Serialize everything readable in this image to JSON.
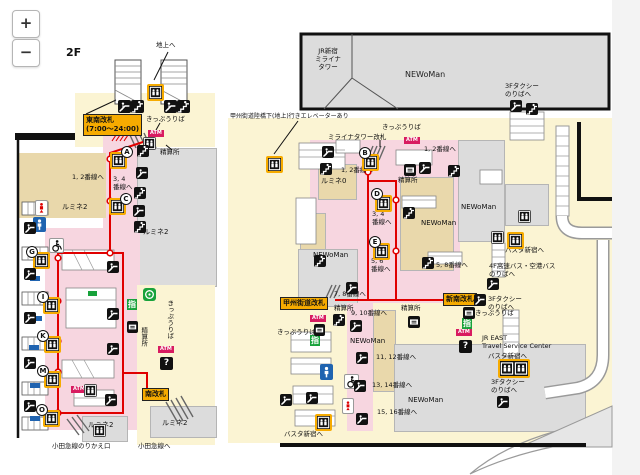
{
  "controls": {
    "zoom_in": "+",
    "zoom_out": "−"
  },
  "floor_label": "2F",
  "colors": {
    "concourse_pink": "#f7d6e0",
    "free_area_yellow": "#fbf4d3",
    "shop_tan": "#e9d8ab",
    "building_gray": "#dcdcdc",
    "gate_orange": "#f6ab00",
    "route_red": "#e00000",
    "atm_magenta": "#d81b60",
    "reserved_seat_green": "#18a23b",
    "restroom_blue": "#1f63b0"
  },
  "left": {
    "to_ground": "地上へ",
    "gate_tonan_l1": "東南改札",
    "gate_tonan_l2": "(7:00～24:00)",
    "ticket_top": "きっぷうりば",
    "fare_top": "精算所",
    "pf12": "1, 2番線へ",
    "pf34_l1": "3, 4",
    "pf34_l2": "番線へ",
    "lumine_left": "ルミネ2",
    "lumine_right": "ルミネ2",
    "lumine_bottom": "ルミネ2",
    "lumine_bottom_right": "ルミネ2",
    "ticket_vert": "きっぷうりば",
    "fare_vert": "精算所",
    "atm_top": "ATM",
    "atm_mid": "ATM",
    "atm_bottom": "ATM",
    "shitei": "指",
    "info_mark": "?",
    "gate_minami": "南改札",
    "odakyu_transfer": "小田急線のりかえ口",
    "odakyu_to": "小田急線へ",
    "letters": {
      "a": "A",
      "c": "C",
      "g": "G",
      "i": "I",
      "k": "K",
      "m": "M",
      "o": "O"
    }
  },
  "right": {
    "tower_l1": "JR新宿",
    "tower_l2": "ミライナ",
    "tower_l3": "タワー",
    "newoman_top": "NEWoMan",
    "elevator_note": "甲州街道陸橋下(地上)行きエレベーターあり",
    "ticket_top": "きっぷうりば",
    "gate_miraina": "ミライナタワー改札",
    "atm_top": "ATM",
    "pf12_right": "1, 2番線へ",
    "pf12_small": "1, 2番線へ",
    "lumine0": "ルミネ0",
    "pf34_l1": "3, 4",
    "pf34_l2": "番線へ",
    "pf56_l1": "5, 6",
    "pf56_l2": "番線へ",
    "fare_mid": "精算所",
    "nw_left": "NEWoMan",
    "nw_mid": "NEWoMan",
    "nw_right": "NEWoMan",
    "nw_low": "NEWoMan",
    "nw_bottom": "NEWoMan",
    "pf58": "5, 8番線へ",
    "taxi1_l1": "3Fタクシー",
    "taxi1_l2": "のりばへ",
    "busta_mid": "バスタ新宿へ",
    "bus4f_l1": "4F高速バス・空港バス",
    "bus4f_l2": "のりばへ",
    "gate_koshu": "甲州街道改札",
    "pf78": "7, 8番線へ",
    "fare_left": "精算所",
    "fare_right": "精算所",
    "pf910": "9, 10番線へ",
    "atm_left": "ATM",
    "ticket_left": "きっぷうりば",
    "shitei_left": "指",
    "pf1112": "11, 12番線へ",
    "pf1314": "13, 14番線へ",
    "pf1516": "15, 16番線へ",
    "gate_shinminami": "新南改札",
    "taxi2_l1": "3Fタクシー",
    "taxi2_l2": "のりばへ",
    "ticket_right": "きっぷうりば",
    "shitei_right": "指",
    "atm_right": "ATM",
    "info_mark": "?",
    "jre_l1": "JR EAST",
    "jre_l2": "Travel Service Center",
    "busta_right": "バスタ新宿へ",
    "taxi3_l1": "3Fタクシー",
    "taxi3_l2": "のりばへ",
    "busta_bottom": "バスタ新宿へ",
    "letters": {
      "b": "B",
      "d": "D",
      "e": "E"
    }
  }
}
